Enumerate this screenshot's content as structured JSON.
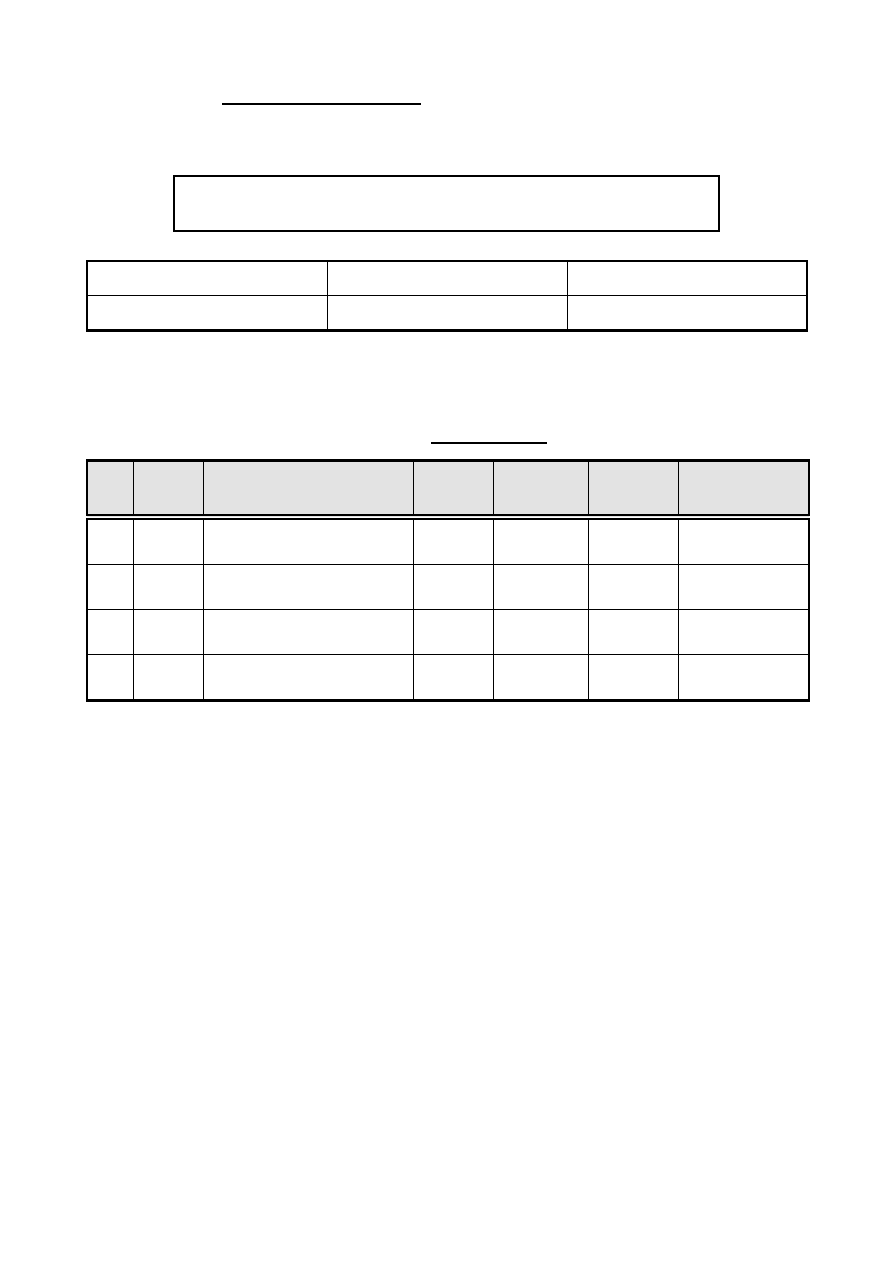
{
  "page": {
    "background_color": "#ffffff",
    "border_color": "#000000"
  },
  "document": {
    "title": {
      "text": ""
    },
    "notice_box": {
      "text": ""
    },
    "info_table": {
      "rows": [
        [
          "",
          "",
          ""
        ],
        [
          "",
          "",
          ""
        ]
      ]
    },
    "section_heading": {
      "text": ""
    },
    "main_table": {
      "header_fill_color": "#e3e3e3",
      "header": [
        "",
        "",
        "",
        "",
        "",
        "",
        ""
      ],
      "rows": [
        [
          "",
          "",
          "",
          "",
          "",
          "",
          ""
        ],
        [
          "",
          "",
          "",
          "",
          "",
          "",
          ""
        ],
        [
          "",
          "",
          "",
          "",
          "",
          "",
          ""
        ],
        [
          "",
          "",
          "",
          "",
          "",
          "",
          ""
        ]
      ]
    }
  }
}
